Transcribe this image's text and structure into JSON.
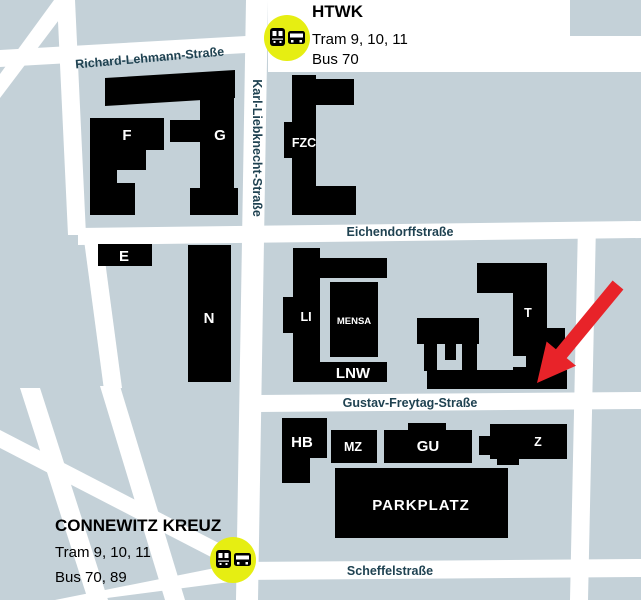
{
  "stops": {
    "htwk": {
      "name": "HTWK",
      "tram": "Tram 9, 10, 11",
      "bus": "Bus 70"
    },
    "connewitz": {
      "name": "CONNEWITZ KREUZ",
      "tram": "Tram 9, 10, 11",
      "bus": "Bus 70, 89"
    }
  },
  "streets": {
    "richard_lehmann": "Richard-Lehmann-Straße",
    "karl_liebknecht": "Karl-Liebknecht-Straße",
    "eichendorff": "Eichendorffstraße",
    "gustav_freytag": "Gustav-Freytag-Straße",
    "scheffel": "Scheffelstraße"
  },
  "buildings": {
    "f": "F",
    "g": "G",
    "e": "E",
    "n": "N",
    "fzc": "FZC",
    "li": "LI",
    "mensa": "MENSA",
    "lnw": "LNW",
    "t": "T",
    "hb": "HB",
    "mz": "MZ",
    "gu": "GU",
    "z": "Z",
    "parkplatz": "PARKPLATZ"
  },
  "icons": {
    "stop_badge": [
      "tram-icon",
      "bus-icon"
    ],
    "marker": "red-arrow-icon"
  },
  "colors": {
    "block_blue": "#c4d1d8",
    "street_white": "#ffffff",
    "building_black": "#000000",
    "street_text_navy": "#1f4251",
    "badge_yellow": "#e6ee12",
    "arrow_red": "#e82329"
  }
}
